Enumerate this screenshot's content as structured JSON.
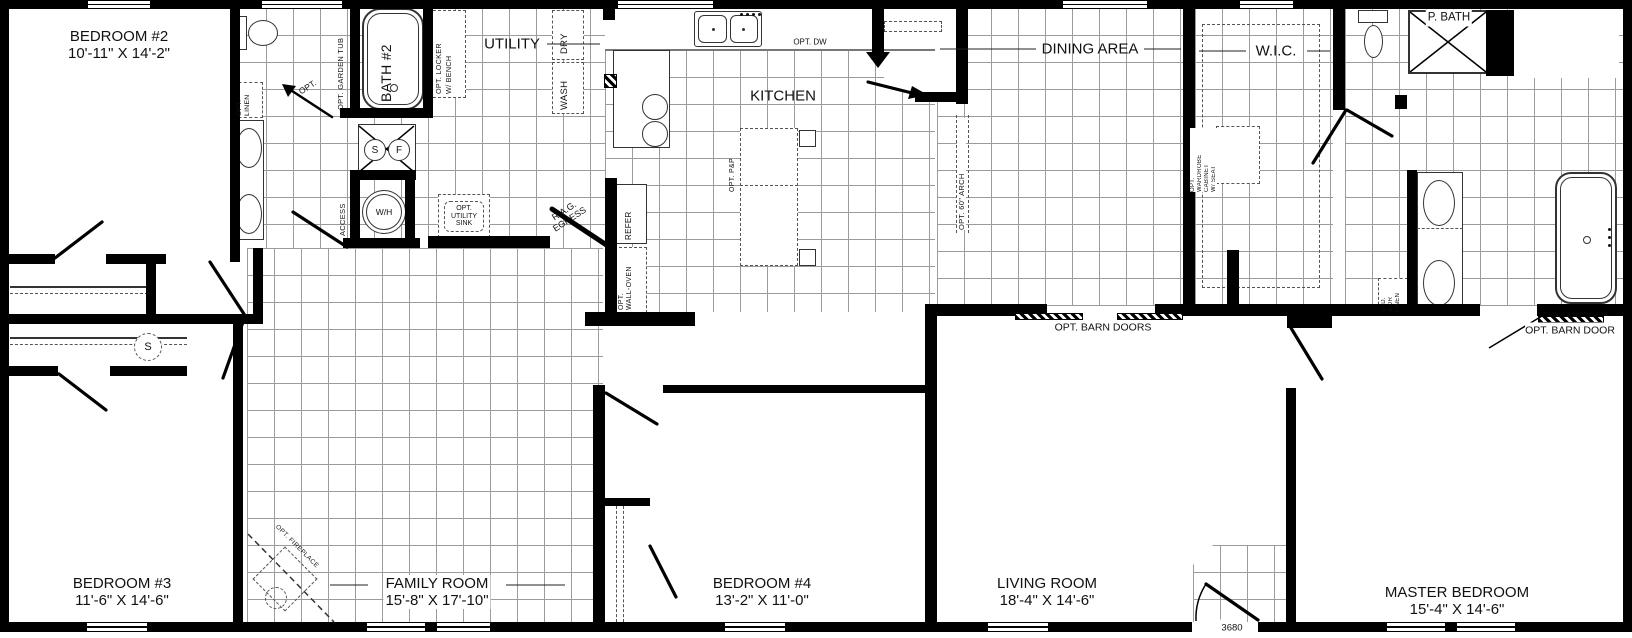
{
  "plan": {
    "model_number": "3680"
  },
  "rooms": [
    {
      "id": "bedroom2",
      "name": "BEDROOM #2",
      "dims": "10'-11\" X 14'-2\""
    },
    {
      "id": "bath2",
      "name": "BATH #2"
    },
    {
      "id": "utility",
      "name": "UTILITY"
    },
    {
      "id": "kitchen",
      "name": "KITCHEN"
    },
    {
      "id": "dining",
      "name": "DINING AREA"
    },
    {
      "id": "wic",
      "name": "W.I.C."
    },
    {
      "id": "pbath",
      "name": "P. BATH"
    },
    {
      "id": "bedroom3",
      "name": "BEDROOM #3",
      "dims": "11'-6\" X 14'-6\""
    },
    {
      "id": "family",
      "name": "FAMILY ROOM",
      "dims": "15'-8\" X 17'-10\""
    },
    {
      "id": "bedroom4",
      "name": "BEDROOM #4",
      "dims": "13'-2\" X 11'-0\""
    },
    {
      "id": "living",
      "name": "LIVING ROOM",
      "dims": "18'-4\" X 14'-6\""
    },
    {
      "id": "master",
      "name": "MASTER BEDROOM",
      "dims": "15'-4\" X 14'-6\""
    }
  ],
  "annotations": {
    "opt_linen": [
      "OPT.",
      "LINEN"
    ],
    "opt": "OPT.",
    "opt_garden_tub": "OPT. GARDEN TUB",
    "opt_locker": [
      "OPT. LOCKER",
      "W/ BENCH"
    ],
    "dry": "DRY",
    "wash": "WASH",
    "access": "ACCESS",
    "wh": "W/H",
    "s": "S",
    "f": "F",
    "shelf_s": "S",
    "opt_utility_sink": [
      "OPT.",
      "UTILITY",
      "SINK"
    ],
    "rag_egress": [
      "R.A.G.",
      "EGRESS"
    ],
    "refer": "REFER",
    "opt_wall_oven": [
      "OPT.",
      "WALL-OVEN"
    ],
    "opt_dw": "OPT. DW",
    "opt_pp": "OPT. P&P",
    "opt_60_arch": "OPT. 60\" ARCH",
    "opt_barn_doors": "OPT. BARN DOORS",
    "opt_barn_door": "OPT. BARN DOOR",
    "opt_wardrobe": [
      "OPT.",
      "WARDROBE",
      "CABINET",
      "W/ SEAT"
    ],
    "std_3dr_linen": [
      "STD.",
      "3-DR",
      "LINEN"
    ],
    "opt_fireplace": "OPT. FIREPLACE",
    "entry_door_size": "3680"
  }
}
